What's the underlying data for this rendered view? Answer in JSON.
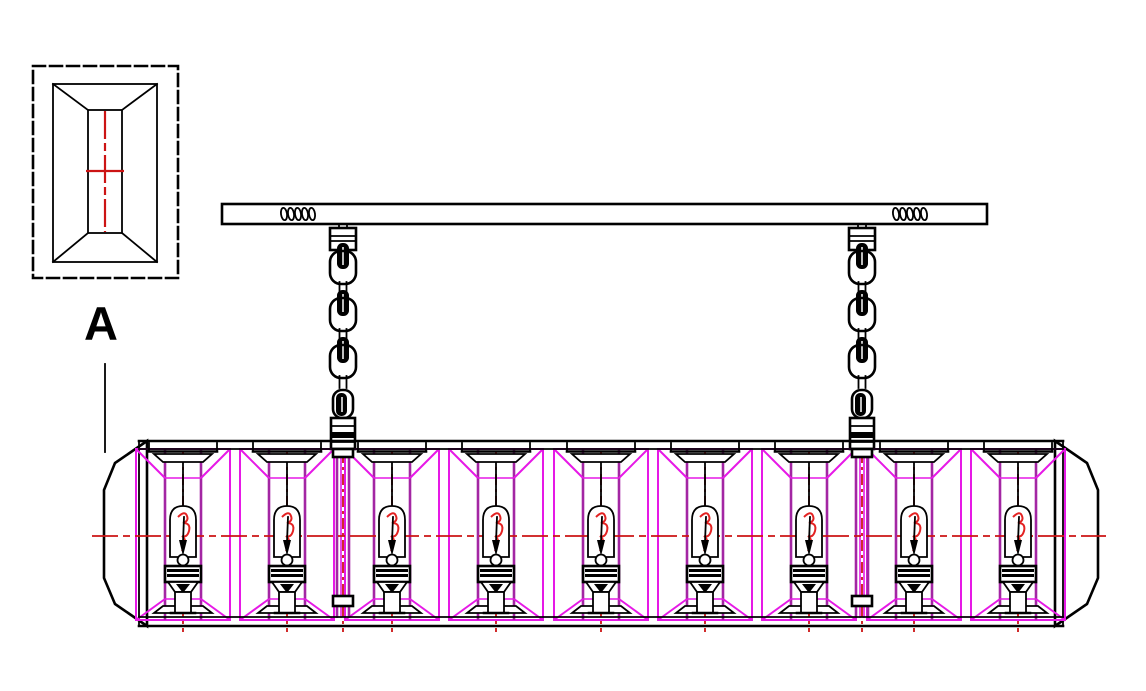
{
  "page": {
    "width": 1146,
    "height": 691,
    "background": "#ffffff"
  },
  "colors": {
    "black": "#000000",
    "frame": "#e619e6",
    "frame_dark": "#a326a3",
    "centerline": "#cc1414",
    "filament": "#e32222",
    "white": "#ffffff"
  },
  "detail_view": {
    "label": "A",
    "dashed_frame": {
      "x": 33,
      "y": 66,
      "w": 145,
      "h": 212
    },
    "outer_rect": {
      "x": 53,
      "y": 84,
      "w": 104,
      "h": 178
    },
    "inner_rect": {
      "x": 88,
      "y": 110,
      "w": 34,
      "h": 123
    },
    "center_x": 105,
    "cross_y": 171,
    "section_line": {
      "x": 105,
      "y1": 364,
      "y2": 452
    }
  },
  "mounting_bar": {
    "x": 222,
    "y": 204,
    "w": 765,
    "h": 20,
    "slot_groups": [
      298,
      910
    ],
    "slots_per_group": 5,
    "slot_spacing": 7
  },
  "chains": {
    "x_positions": [
      343,
      862
    ],
    "top_y": 224,
    "cluster_ys": [
      251,
      298,
      345
    ],
    "attach_y": 449
  },
  "fixture": {
    "cap_left_tip": 104,
    "cap_right_tip": 1098,
    "body_left": 139,
    "body_right": 1063,
    "top": 441,
    "top_inner": 449,
    "bottom_inner": 617,
    "bottom": 626,
    "lamp_count": 9,
    "lamp_centers": [
      183,
      287,
      392,
      496,
      601,
      705,
      809,
      914,
      1018
    ],
    "cell_half_width": 47,
    "cell_inner_half": 18,
    "cell_inner_top": 478,
    "cell_inner_bottom": 599,
    "cell_bottom": 620,
    "post_x": [
      343,
      862
    ],
    "centerline": {
      "y": 536,
      "x1": 92,
      "x2": 1106
    }
  }
}
